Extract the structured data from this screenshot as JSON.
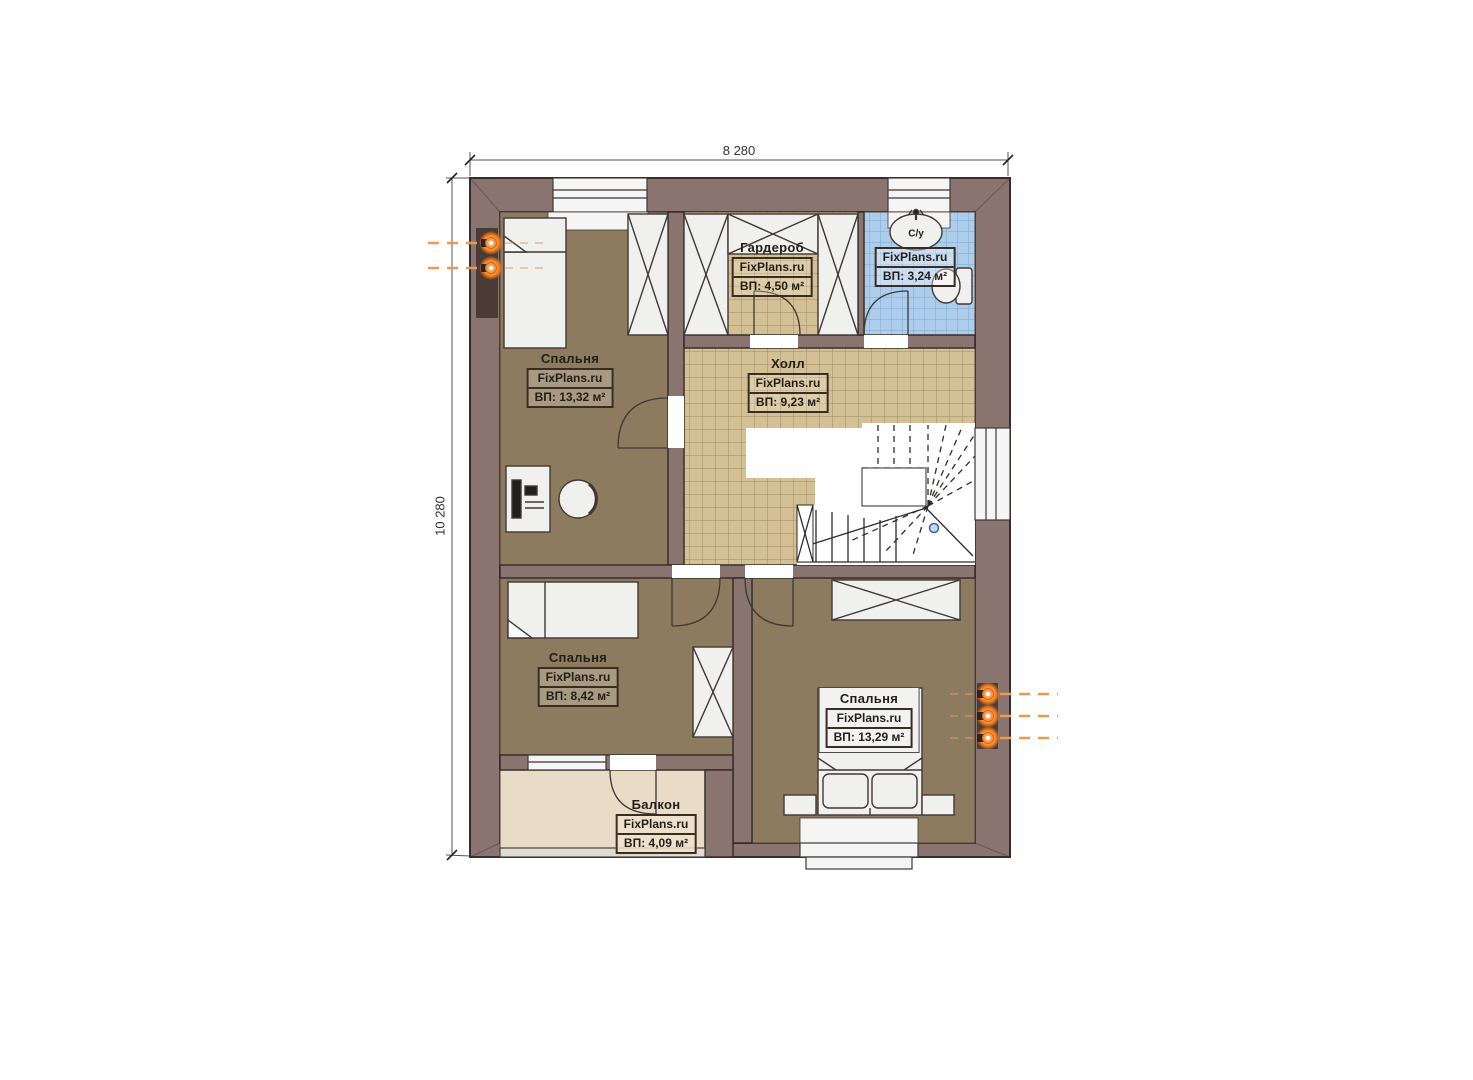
{
  "dimensions": {
    "width_label": "8 280",
    "height_label": "10 280"
  },
  "rooms": {
    "bedroom_top_left": {
      "name": "Спальня",
      "brand": "FixPlans.ru",
      "area": "ВП: 13,32 м²"
    },
    "wardrobe_room": {
      "name": "Гардероб",
      "brand": "FixPlans.ru",
      "area": "ВП: 4,50 м²"
    },
    "bathroom": {
      "name": "С/у",
      "brand": "FixPlans.ru",
      "area": "ВП: 3,24 м²"
    },
    "hall": {
      "name": "Холл",
      "brand": "FixPlans.ru",
      "area": "ВП: 9,23 м²"
    },
    "bedroom_mid_left": {
      "name": "Спальня",
      "brand": "FixPlans.ru",
      "area": "ВП: 8,42 м²"
    },
    "bedroom_right": {
      "name": "Спальня",
      "brand": "FixPlans.ru",
      "area": "ВП: 13,29 м²"
    },
    "balcony": {
      "name": "Балкон",
      "brand": "FixPlans.ru",
      "area": "ВП: 4,09 м²"
    }
  },
  "colors": {
    "wall": "#8a7470",
    "wall_outline": "#352e2a",
    "floor_bedroom": "#8d7b5f",
    "floor_hall_tile": "#d3c094",
    "floor_bathroom_tile": "#accdeb",
    "floor_balcony": "#e8dcc7",
    "furniture": "#f0f1ef",
    "radiator_orange": "#f07818",
    "stair_marker_blue": "#3c62a8"
  }
}
